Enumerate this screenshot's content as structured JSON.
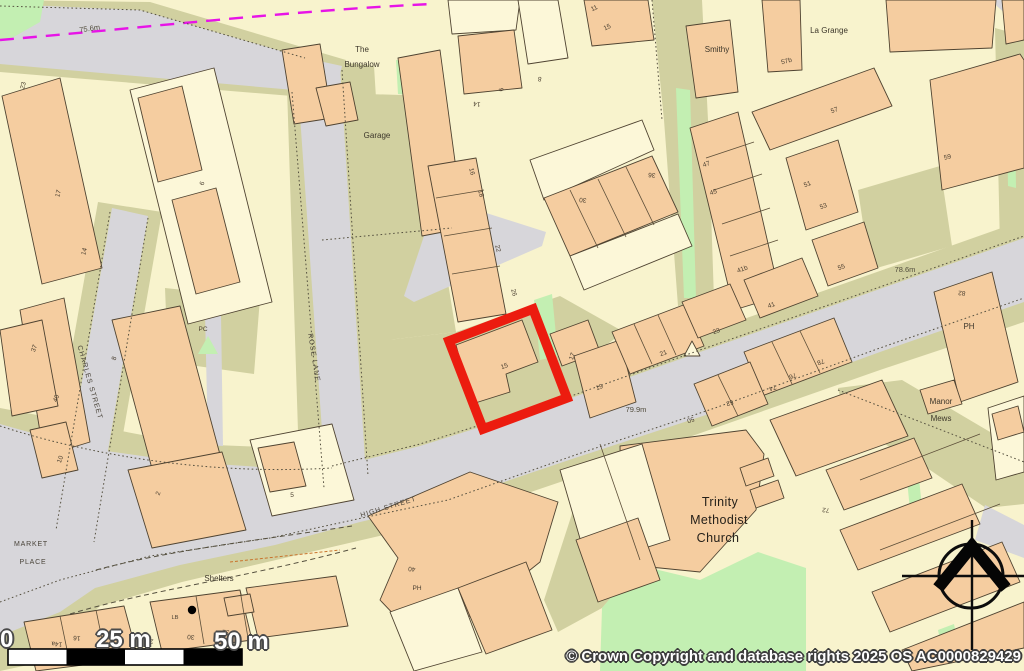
{
  "map": {
    "copyright": "© Crown Copyright and database rights 2025 OS AC0000829429",
    "scale_bar": {
      "zero": "0",
      "mid": "25 m",
      "end": "50 m"
    },
    "colors": {
      "bg": "#f8f3cd",
      "orange": "#f5cda0",
      "pale": "#fcf7d8",
      "olive": "#d1d0a0",
      "road": "#d7d6da",
      "green": "#c3efb2",
      "red": "#ec1c0f",
      "magenta": "#e714e7",
      "stroke": "#4f4331"
    },
    "labels": [
      {
        "t": "75.6m",
        "x": 90,
        "y": 31,
        "r": -8,
        "c": "e"
      },
      {
        "t": "78.6m",
        "x": 905,
        "y": 272,
        "r": 0,
        "c": "e"
      },
      {
        "t": "79.9m",
        "x": 636,
        "y": 412,
        "r": 0,
        "c": "e"
      },
      {
        "t": "The",
        "x": 362,
        "y": 52,
        "r": 0,
        "c": "p"
      },
      {
        "t": "Bungalow",
        "x": 362,
        "y": 67,
        "r": 0,
        "c": "p"
      },
      {
        "t": "Garage",
        "x": 377,
        "y": 138,
        "r": 0,
        "c": "p"
      },
      {
        "t": "Smithy",
        "x": 717,
        "y": 52,
        "r": 0,
        "c": "p"
      },
      {
        "t": "La Grange",
        "x": 829,
        "y": 33,
        "r": 0,
        "c": "p"
      },
      {
        "t": "Manor",
        "x": 941,
        "y": 404,
        "r": 0,
        "c": "p"
      },
      {
        "t": "Mews",
        "x": 941,
        "y": 421,
        "r": 0,
        "c": "p"
      },
      {
        "t": "Trinity",
        "x": 720,
        "y": 506,
        "r": 0,
        "c": "lg"
      },
      {
        "t": "Methodist",
        "x": 719,
        "y": 524,
        "r": 0,
        "c": "lg"
      },
      {
        "t": "Church",
        "x": 718,
        "y": 542,
        "r": 0,
        "c": "lg"
      },
      {
        "t": "Shelters",
        "x": 219,
        "y": 581,
        "r": 0,
        "c": "p"
      },
      {
        "t": "MARKET",
        "x": 31,
        "y": 546,
        "r": 0,
        "c": "st2"
      },
      {
        "t": "PLACE",
        "x": 33,
        "y": 564,
        "r": 0,
        "c": "st2"
      },
      {
        "t": "CHARLES STREET",
        "x": 88,
        "y": 383,
        "r": 74,
        "c": "st"
      },
      {
        "t": "ROSE LANE",
        "x": 312,
        "y": 358,
        "r": 81,
        "c": "st"
      },
      {
        "t": "HIGH STREET",
        "x": 389,
        "y": 509,
        "r": -17,
        "c": "st"
      },
      {
        "t": "PC",
        "x": 203,
        "y": 331,
        "r": 0,
        "c": "n"
      },
      {
        "t": "LB",
        "x": 175,
        "y": 619,
        "r": 0,
        "c": "n6"
      },
      {
        "t": "PH",
        "x": 969,
        "y": 329,
        "r": 0,
        "c": "n8"
      },
      {
        "t": "PH",
        "x": 417,
        "y": 590,
        "r": 0,
        "c": "n"
      },
      {
        "t": "40",
        "x": 412,
        "y": 567,
        "r": 185,
        "c": "n"
      },
      {
        "t": "82",
        "x": 962,
        "y": 291,
        "r": 185,
        "c": "n"
      },
      {
        "t": "15",
        "x": 505,
        "y": 368,
        "r": -20,
        "c": "n"
      },
      {
        "t": "17",
        "x": 574,
        "y": 357,
        "r": -70,
        "c": "n"
      },
      {
        "t": "19",
        "x": 600,
        "y": 389,
        "r": -20,
        "c": "n"
      },
      {
        "t": "21",
        "x": 664,
        "y": 355,
        "r": -20,
        "c": "n"
      },
      {
        "t": "23",
        "x": 717,
        "y": 333,
        "r": -20,
        "c": "n"
      },
      {
        "t": "41",
        "x": 772,
        "y": 307,
        "r": -20,
        "c": "n"
      },
      {
        "t": "41b",
        "x": 743,
        "y": 271,
        "r": -20,
        "c": "n"
      },
      {
        "t": "45",
        "x": 714,
        "y": 194,
        "r": -20,
        "c": "n"
      },
      {
        "t": "47",
        "x": 707,
        "y": 166,
        "r": -20,
        "c": "n"
      },
      {
        "t": "51",
        "x": 808,
        "y": 186,
        "r": -20,
        "c": "n"
      },
      {
        "t": "53",
        "x": 824,
        "y": 208,
        "r": -20,
        "c": "n"
      },
      {
        "t": "55",
        "x": 842,
        "y": 269,
        "r": -20,
        "c": "n"
      },
      {
        "t": "57",
        "x": 835,
        "y": 112,
        "r": -20,
        "c": "n"
      },
      {
        "t": "57b",
        "x": 787,
        "y": 63,
        "r": -15,
        "c": "n"
      },
      {
        "t": "59",
        "x": 948,
        "y": 159,
        "r": -15,
        "c": "n"
      },
      {
        "t": "78",
        "x": 820,
        "y": 360,
        "r": 160,
        "c": "n"
      },
      {
        "t": "76",
        "x": 792,
        "y": 374,
        "r": 160,
        "c": "n"
      },
      {
        "t": "74",
        "x": 772,
        "y": 386,
        "r": 160,
        "c": "n"
      },
      {
        "t": "52",
        "x": 729,
        "y": 401,
        "r": 160,
        "c": "n"
      },
      {
        "t": "50",
        "x": 690,
        "y": 418,
        "r": 160,
        "c": "n"
      },
      {
        "t": "72",
        "x": 826,
        "y": 508,
        "r": 185,
        "c": "n"
      },
      {
        "t": "30",
        "x": 583,
        "y": 198,
        "r": 185,
        "c": "n"
      },
      {
        "t": "36",
        "x": 652,
        "y": 173,
        "r": 185,
        "c": "n"
      },
      {
        "t": "16",
        "x": 470,
        "y": 172,
        "r": 75,
        "c": "n"
      },
      {
        "t": "18",
        "x": 479,
        "y": 194,
        "r": 75,
        "c": "n"
      },
      {
        "t": "22",
        "x": 496,
        "y": 249,
        "r": 75,
        "c": "n"
      },
      {
        "t": "26",
        "x": 512,
        "y": 293,
        "r": 75,
        "c": "n"
      },
      {
        "t": "14",
        "x": 477,
        "y": 102,
        "r": 185,
        "c": "n"
      },
      {
        "t": "8",
        "x": 540,
        "y": 77,
        "r": 185,
        "c": "n"
      },
      {
        "t": "9",
        "x": 499,
        "y": 90,
        "r": 80,
        "c": "n"
      },
      {
        "t": "11",
        "x": 595,
        "y": 10,
        "r": -25,
        "c": "n"
      },
      {
        "t": "15",
        "x": 608,
        "y": 29,
        "r": -25,
        "c": "n"
      },
      {
        "t": "23",
        "x": 25,
        "y": 86,
        "r": -75,
        "c": "n"
      },
      {
        "t": "17",
        "x": 60,
        "y": 194,
        "r": -75,
        "c": "n"
      },
      {
        "t": "14",
        "x": 86,
        "y": 252,
        "r": -75,
        "c": "n"
      },
      {
        "t": "37",
        "x": 36,
        "y": 349,
        "r": -70,
        "c": "n"
      },
      {
        "t": "40",
        "x": 58,
        "y": 399,
        "r": -70,
        "c": "n"
      },
      {
        "t": "10",
        "x": 62,
        "y": 460,
        "r": -70,
        "c": "n"
      },
      {
        "t": "8",
        "x": 116,
        "y": 359,
        "r": -70,
        "c": "n"
      },
      {
        "t": "2",
        "x": 160,
        "y": 494,
        "r": -70,
        "c": "n"
      },
      {
        "t": "5",
        "x": 292,
        "y": 497,
        "r": 0,
        "c": "n"
      },
      {
        "t": "6",
        "x": 204,
        "y": 184,
        "r": -70,
        "c": "n"
      },
      {
        "t": "12",
        "x": 40,
        "y": 649,
        "r": 185,
        "c": "n"
      },
      {
        "t": "14a",
        "x": 57,
        "y": 642,
        "r": 185,
        "c": "n"
      },
      {
        "t": "16",
        "x": 77,
        "y": 636,
        "r": 185,
        "c": "n"
      },
      {
        "t": "26",
        "x": 150,
        "y": 639,
        "r": 185,
        "c": "n"
      },
      {
        "t": "30",
        "x": 191,
        "y": 635,
        "r": 185,
        "c": "n"
      },
      {
        "t": "32",
        "x": 226,
        "y": 630,
        "r": 185,
        "c": "n"
      },
      {
        "t": "28",
        "x": 198,
        "y": 658,
        "r": 185,
        "c": "n"
      }
    ],
    "geometry": {
      "red_plot": "449,341 533,309 567,398 483,429",
      "olive": [
        {
          "p": "0,0 150,2 312,50 346,60 338,104 292,96 0,72"
        },
        {
          "p": "286,56 374,66 400,482 300,494"
        },
        {
          "p": "98,202 162,212 102,554 40,528"
        },
        {
          "p": "0,408 190,444 340,450 565,382 860,278 1024,220 1024,322 880,370 578,476 448,520 362,540 276,560 182,582 100,606 42,662 0,671"
        },
        {
          "p": "300,92 434,96 450,168 430,172 456,332 336,346 322,240"
        },
        {
          "p": "336,346 456,332 560,296 624,332 602,348 620,432 470,454 352,472"
        },
        {
          "p": "652,0 702,0 708,120 714,300 678,306 664,120"
        },
        {
          "p": "594,446 632,444 642,562 602,608 558,632 544,600"
        },
        {
          "p": "838,388 902,380 1024,452 1024,504 986,508 930,470 846,422"
        },
        {
          "p": "165,288 260,298 254,374 168,362"
        },
        {
          "p": "995,28 1024,36 1024,252 1000,246"
        },
        {
          "p": "858,190 940,166 952,246 870,270"
        }
      ],
      "roads": [
        {
          "p": "0,4 140,10 305,58 342,66 334,98 294,90 0,64"
        },
        {
          "p": "296,58 340,66 366,476 326,488"
        },
        {
          "p": "112,208 148,216 92,544 56,532"
        },
        {
          "p": "0,424 85,448 185,462 275,468 332,468 420,446 560,402 700,352 860,296 1024,238 1024,302 880,352 715,412 575,458 445,502 360,522 275,545 180,565 95,588 60,612 0,636"
        },
        {
          "p": "985,505 1024,525 1024,558 975,540"
        },
        {
          "p": "990,0 1024,0 1024,30"
        },
        {
          "p": "205,312 221,314 223,446 208,445"
        },
        {
          "p": "436,200 452,202 546,232 542,246 414,302 404,296"
        }
      ],
      "green": [
        {
          "p": "0,0 44,0 40,22 12,38 0,40"
        },
        {
          "p": "396,60 418,62 416,96 398,94"
        },
        {
          "p": "676,88 690,90 696,298 684,298"
        },
        {
          "p": "1006,60 1014,62 1016,188 1008,186"
        },
        {
          "p": "602,608 638,565 700,580 758,552 806,568 806,671 600,671"
        },
        {
          "p": "455,581 475,581 475,600 455,600"
        },
        {
          "p": "198,354 208,336 218,354"
        },
        {
          "p": "906,470 918,468 922,508 910,510"
        },
        {
          "p": "938,630 954,624 960,654 944,660"
        },
        {
          "p": "534,300 552,294 558,356 540,360"
        }
      ],
      "buildings": [
        {
          "p": "2,96 60,78 102,268 42,284",
          "f": "o"
        },
        {
          "p": "20,310 64,298 90,442 44,456",
          "f": "o"
        },
        {
          "p": "0,330 42,320 58,406 12,416",
          "f": "o"
        },
        {
          "p": "30,430 66,422 78,470 42,478",
          "f": "o"
        },
        {
          "p": "130,90 214,68 272,302 188,324",
          "f": "y"
        },
        {
          "p": "138,98 182,86 202,170 158,182",
          "f": "o"
        },
        {
          "p": "172,200 216,188 240,282 196,294",
          "f": "o"
        },
        {
          "p": "112,320 180,306 222,462 154,476",
          "f": "o"
        },
        {
          "p": "128,470 222,452 246,530 152,548",
          "f": "o"
        },
        {
          "p": "250,440 332,424 354,500 272,516",
          "f": "y"
        },
        {
          "p": "258,448 294,442 306,486 270,492",
          "f": "o"
        },
        {
          "p": "282,50 320,44 332,118 294,124",
          "f": "o"
        },
        {
          "p": "316,88 350,82 358,120 326,126",
          "f": "o"
        },
        {
          "p": "398,58 440,50 464,228 422,236",
          "f": "o"
        },
        {
          "p": "428,166 476,158 506,314 458,322",
          "f": "o"
        },
        {
          "p": "448,0 520,0 516,30 452,34",
          "f": "y"
        },
        {
          "p": "458,36 514,30 522,88 464,94",
          "f": "o"
        },
        {
          "p": "530,160 642,120 654,150 544,200",
          "f": "y"
        },
        {
          "p": "544,198 652,156 678,212 570,256",
          "f": "o"
        },
        {
          "p": "570,256 678,214 692,246 584,290",
          "f": "y"
        },
        {
          "p": "690,128 738,112 780,296 734,310",
          "f": "o"
        },
        {
          "p": "744,280 802,258 818,296 760,318",
          "f": "o"
        },
        {
          "p": "786,158 838,140 858,212 806,230",
          "f": "o"
        },
        {
          "p": "812,240 864,222 878,268 828,286",
          "f": "o"
        },
        {
          "p": "752,112 874,68 892,106 770,150",
          "f": "o"
        },
        {
          "p": "762,0 800,0 802,70 768,72",
          "f": "o"
        },
        {
          "p": "686,26 730,20 738,92 696,98",
          "f": "o"
        },
        {
          "p": "886,0 996,0 992,48 890,52",
          "f": "o"
        },
        {
          "p": "930,80 1020,54 1024,60 1024,168 942,190",
          "f": "o"
        },
        {
          "p": "1002,0 1024,0 1024,40 1006,44",
          "f": "o"
        },
        {
          "p": "934,292 992,272 1018,382 960,402",
          "f": "o"
        },
        {
          "p": "744,352 834,318 852,362 762,396",
          "f": "o"
        },
        {
          "p": "694,384 750,362 768,404 712,426",
          "f": "o"
        },
        {
          "p": "550,334 588,320 600,352 562,366",
          "f": "o"
        },
        {
          "p": "574,356 620,340 636,402 590,418",
          "f": "o"
        },
        {
          "p": "612,332 686,304 704,346 630,374",
          "f": "o"
        },
        {
          "p": "682,302 730,284 746,320 698,338",
          "f": "o"
        },
        {
          "p": "456,345 522,320 538,362 506,374 510,392 472,404",
          "f": "o"
        },
        {
          "p": "620,446 746,430 764,454 756,510 700,572 640,566 622,540",
          "f": "o"
        },
        {
          "p": "740,468 768,458 774,476 746,486",
          "f": "o"
        },
        {
          "p": "750,490 778,480 784,498 756,508",
          "f": "o"
        },
        {
          "p": "368,516 470,472 558,502 540,562 480,610 422,644 380,600 398,558",
          "f": "o"
        },
        {
          "p": "560,470 642,444 670,540 588,566",
          "f": "y"
        },
        {
          "p": "576,540 638,518 660,580 598,602",
          "f": "o"
        },
        {
          "p": "770,420 882,380 908,436 796,476",
          "f": "o"
        },
        {
          "p": "826,470 914,438 932,478 844,510",
          "f": "o"
        },
        {
          "p": "840,530 962,484 980,524 858,570",
          "f": "o"
        },
        {
          "p": "872,592 1002,542 1020,582 890,632",
          "f": "o"
        },
        {
          "p": "902,650 1024,602 1024,648 912,671",
          "f": "o"
        },
        {
          "p": "920,390 954,380 962,404 928,414",
          "f": "o"
        },
        {
          "p": "988,408 1024,396 1024,472 996,480",
          "f": "y"
        },
        {
          "p": "992,414 1018,406 1024,432 998,440",
          "f": "o"
        },
        {
          "p": "24,622 124,606 138,658 36,671",
          "f": "o"
        },
        {
          "p": "150,602 240,590 252,640 162,652",
          "f": "o"
        },
        {
          "p": "246,588 336,576 348,626 258,638",
          "f": "o"
        },
        {
          "p": "224,598 250,594 254,612 228,616",
          "f": "o"
        },
        {
          "p": "390,612 458,588 482,652 414,671",
          "f": "y"
        },
        {
          "p": "458,588 526,562 552,630 486,654",
          "f": "o"
        },
        {
          "p": "518,0 558,0 568,58 528,64",
          "f": "y"
        },
        {
          "p": "584,0 648,0 654,40 592,46",
          "f": "o"
        },
        {
          "p": "684,356 692,341 700,356",
          "f": "y"
        }
      ],
      "lines": [
        {
          "d": "M332,466 L420,444 L560,400 L700,350 L860,294 L1024,236",
          "s": "dot"
        },
        {
          "d": "M0,602 L60,580 L150,556 L270,538 L362,518 L448,500 L578,454 L715,408 L880,348 L1024,298",
          "s": "dot"
        },
        {
          "d": "M342,70 L368,476",
          "s": "dot"
        },
        {
          "d": "M292,92 L324,488",
          "s": "dot"
        },
        {
          "d": "M148,218 L94,542",
          "s": "dot"
        },
        {
          "d": "M110,212 L56,530",
          "s": "dot"
        },
        {
          "d": "M0,40 C140,28 300,10 432,4",
          "s": "mag"
        },
        {
          "d": "M0,426 C80,452 200,476 332,468",
          "s": "dot"
        },
        {
          "d": "M96,570 C170,550 260,540 352,526",
          "s": "dash"
        },
        {
          "d": "M70,614 C150,590 245,578 356,548",
          "s": "dash"
        },
        {
          "d": "M0,6 L140,10 L305,58",
          "s": "dot"
        },
        {
          "d": "M322,240 L452,228",
          "s": "dot"
        },
        {
          "d": "M838,390 L1024,462",
          "s": "dot"
        },
        {
          "d": "M652,0 L662,120",
          "s": "dot"
        },
        {
          "d": "M570,190 L598,248",
          "s": "thin"
        },
        {
          "d": "M598,179 L626,237",
          "s": "thin"
        },
        {
          "d": "M626,167 L654,225",
          "s": "thin"
        },
        {
          "d": "M706,158 L754,142",
          "s": "thin"
        },
        {
          "d": "M714,190 L762,174",
          "s": "thin"
        },
        {
          "d": "M722,224 L770,208",
          "s": "thin"
        },
        {
          "d": "M730,256 L778,240",
          "s": "thin"
        },
        {
          "d": "M436,198 L484,190",
          "s": "thin"
        },
        {
          "d": "M444,236 L492,228",
          "s": "thin"
        },
        {
          "d": "M452,274 L500,266",
          "s": "thin"
        },
        {
          "d": "M772,342 L792,384",
          "s": "thin"
        },
        {
          "d": "M800,331 L820,373",
          "s": "thin"
        },
        {
          "d": "M718,375 L738,416",
          "s": "thin"
        },
        {
          "d": "M634,324 L652,364",
          "s": "thin"
        },
        {
          "d": "M658,315 L676,355",
          "s": "thin"
        },
        {
          "d": "M60,616 L70,664",
          "s": "thin"
        },
        {
          "d": "M96,610 L106,658",
          "s": "thin"
        },
        {
          "d": "M196,596 L204,644",
          "s": "thin"
        },
        {
          "d": "M240,590 L248,638",
          "s": "thin"
        },
        {
          "d": "M600,444 L640,560",
          "s": "thin"
        },
        {
          "d": "M860,480 L980,434",
          "s": "thin"
        },
        {
          "d": "M880,550 L1000,504",
          "s": "thin"
        },
        {
          "d": "M230,562 L340,550",
          "s": "odash"
        }
      ]
    }
  }
}
